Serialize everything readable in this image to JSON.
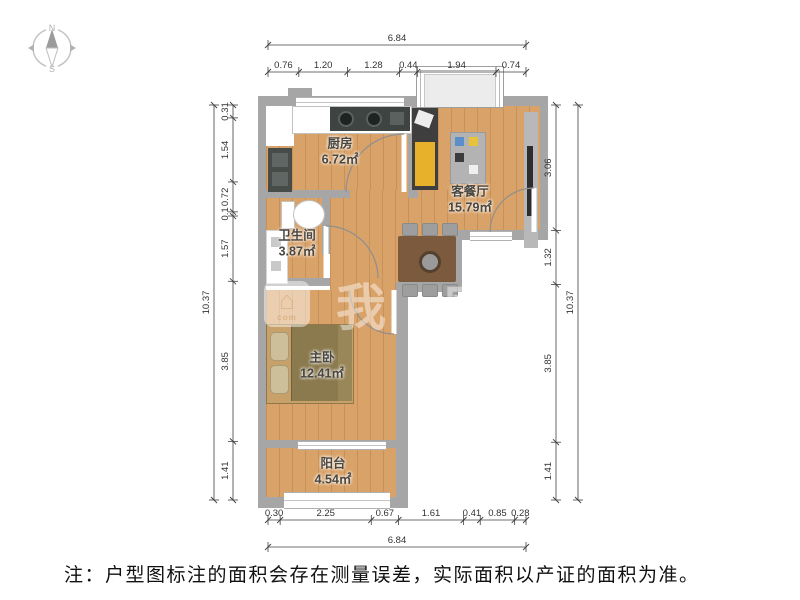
{
  "compass": {
    "north_label": "N",
    "south_label": "S"
  },
  "rooms": [
    {
      "id": "kitchen",
      "name": "厨房",
      "area": "6.72㎡"
    },
    {
      "id": "living",
      "name": "客餐厅",
      "area": "15.79㎡"
    },
    {
      "id": "bathroom",
      "name": "卫生间",
      "area": "3.87㎡"
    },
    {
      "id": "bedroom",
      "name": "主卧",
      "area": "12.41㎡"
    },
    {
      "id": "balcony",
      "name": "阳台",
      "area": "4.54㎡"
    }
  ],
  "dimensions": {
    "top": {
      "overall": "6.84",
      "segments": [
        "0.76",
        "1.20",
        "1.28",
        "0.44",
        "1.94",
        "0.74"
      ]
    },
    "bottom": {
      "overall": "6.84",
      "segments": [
        "0.30",
        "2.25",
        "0.67",
        "1.61",
        "0.41",
        "0.85",
        "0.28"
      ]
    },
    "left": {
      "overall": "10.37",
      "segments": [
        "0.31",
        "1.54",
        "0.72",
        "0.1",
        "1.57",
        "3.85",
        "1.41"
      ]
    },
    "right": {
      "overall": "10.37",
      "segments": [
        "3.06",
        "1.32",
        "3.85",
        "1.41"
      ]
    }
  },
  "watermark": {
    "logo_sub": "com",
    "brand_text": "我家"
  },
  "note": "注：户型图标注的面积会存在测量误差，实际面积以产证的面积为准。",
  "colors": {
    "wall": "#a6a6a6",
    "floor": "#d9a268",
    "accent_yellow": "#e8b12c",
    "bed": "#8c7a4f",
    "table": "#7b5a3e",
    "dim_line": "#3f3f3f"
  }
}
